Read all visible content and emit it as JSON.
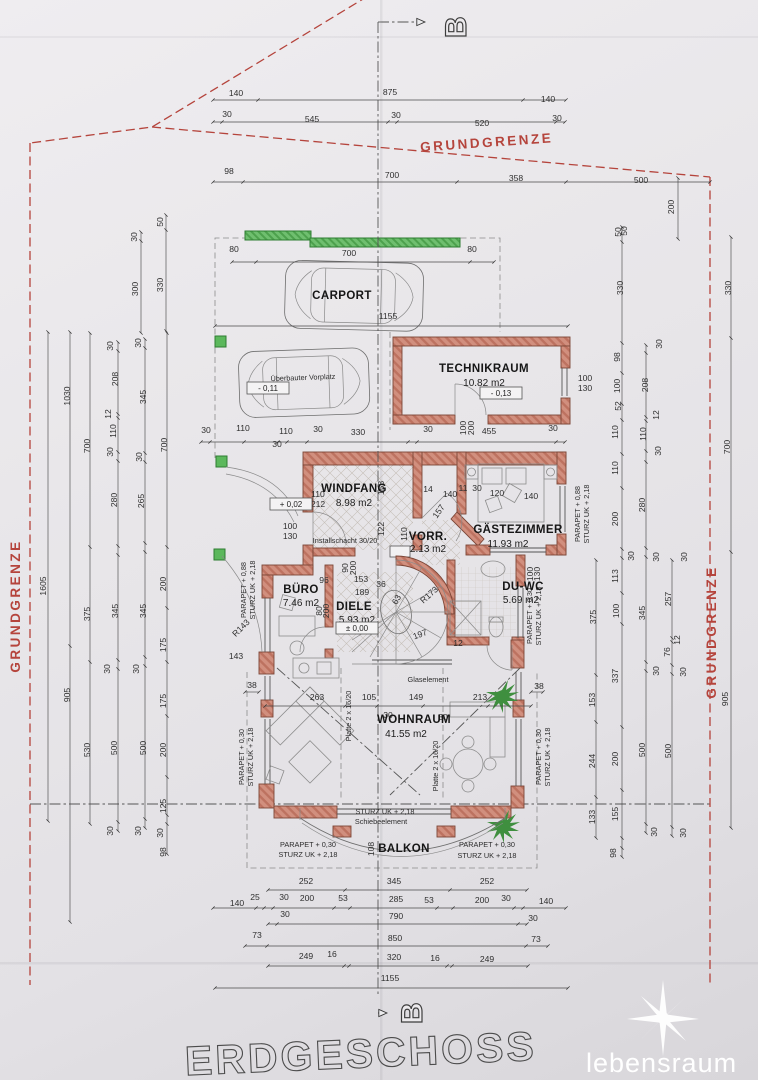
{
  "meta": {
    "title": "ERDGESCHOSS",
    "logo": "lebensraum",
    "section_marker": "B"
  },
  "boundary": {
    "label": "GRUNDGRENZE",
    "color": "#b5443c",
    "instances": [
      {
        "x": 487,
        "y": 147,
        "r": -4
      },
      {
        "x": 20,
        "y": 606,
        "r": -90
      },
      {
        "x": 716,
        "y": 632,
        "r": -90
      }
    ]
  },
  "colors": {
    "wall": "#cf8f7e",
    "wall_edge": "#7c4637",
    "green": "#5cb85c",
    "boundary": "#b5443c",
    "paper": "#e8e6e9",
    "line": "#4a4a4a"
  },
  "rooms": [
    {
      "name": "CARPORT",
      "x": 342,
      "y": 299
    },
    {
      "name": "TECHNIKRAUM",
      "area": "10.82 m2",
      "x": 484,
      "y": 372,
      "ax": 484,
      "ay": 386
    },
    {
      "name": "WINDFANG",
      "area": "8.98 m2",
      "x": 354,
      "y": 492,
      "ax": 354,
      "ay": 506
    },
    {
      "name": "VORR.",
      "area": "2.13 m2",
      "x": 428,
      "y": 540,
      "ax": 428,
      "ay": 552
    },
    {
      "name": "GÄSTEZIMMER",
      "area": "11.93 m2",
      "x": 518,
      "y": 533,
      "ax": 508,
      "ay": 547
    },
    {
      "name": "BÜRO",
      "area": "7.46 m2",
      "x": 301,
      "y": 593,
      "ax": 301,
      "ay": 606
    },
    {
      "name": "DIELE",
      "area": "5.93 m2",
      "x": 354,
      "y": 610,
      "ax": 357,
      "ay": 623
    },
    {
      "name": "DU-WC",
      "area": "5.69 m2",
      "x": 523,
      "y": 590,
      "ax": 521,
      "ay": 603
    },
    {
      "name": "WOHNRAUM",
      "area": "41.55 m2",
      "x": 414,
      "y": 723,
      "ax": 406,
      "ay": 737
    },
    {
      "name": "BALKON",
      "x": 404,
      "y": 852
    }
  ],
  "level_boxes": [
    {
      "t": "- 0,11",
      "x": 268,
      "y": 391
    },
    {
      "t": "- 0,13",
      "x": 501,
      "y": 396
    },
    {
      "t": "+ 0,02",
      "x": 291,
      "y": 507
    },
    {
      "t": "± 0,00",
      "x": 357,
      "y": 631
    }
  ],
  "notes": [
    {
      "t": "Überbauter Vorplatz",
      "x": 303,
      "y": 380,
      "r": -2
    },
    {
      "t": "Installschacht 30/20",
      "x": 345,
      "y": 543
    },
    {
      "t": "Glaselement",
      "x": 428,
      "y": 682
    },
    {
      "t": "STURZ UK + 2,18",
      "x": 385,
      "y": 814
    },
    {
      "t": "Schiebeelement",
      "x": 381,
      "y": 824
    },
    {
      "t": "PARAPET + 0,30",
      "x": 308,
      "y": 847
    },
    {
      "t": "STURZ UK + 2,18",
      "x": 308,
      "y": 857
    },
    {
      "t": "PARAPET + 0,30",
      "x": 487,
      "y": 847
    },
    {
      "t": "STURZ UK + 2,18",
      "x": 487,
      "y": 858
    },
    {
      "t": "PARAPET + 0,88",
      "x": 246,
      "y": 590,
      "r": -90
    },
    {
      "t": "STURZ UK + 2,18",
      "x": 255,
      "y": 590,
      "r": -90
    },
    {
      "t": "PARAPET + 0,30",
      "x": 244,
      "y": 757,
      "r": -90
    },
    {
      "t": "STURZ UK + 2,18",
      "x": 253,
      "y": 757,
      "r": -90
    },
    {
      "t": "PARAPET + 0,88",
      "x": 580,
      "y": 514,
      "r": -90
    },
    {
      "t": "STURZ UK + 2,18",
      "x": 589,
      "y": 514,
      "r": -90
    },
    {
      "t": "PARAPET + 0,30",
      "x": 532,
      "y": 616,
      "r": -90
    },
    {
      "t": "STURZ UK + 2,18",
      "x": 541,
      "y": 616,
      "r": -90
    },
    {
      "t": "PARAPET + 0,30",
      "x": 541,
      "y": 757,
      "r": -90
    },
    {
      "t": "STURZ UK + 2,18",
      "x": 550,
      "y": 757,
      "r": -90
    },
    {
      "t": "Platte 2 x 16/20",
      "x": 351,
      "y": 716,
      "r": -90
    },
    {
      "t": "Platte 2 x 16/20",
      "x": 438,
      "y": 766,
      "r": -90
    }
  ],
  "dims": [
    [
      "140",
      236,
      96
    ],
    [
      "875",
      390,
      95
    ],
    [
      "140",
      548,
      102
    ],
    [
      "30",
      227,
      117
    ],
    [
      "545",
      312,
      122
    ],
    [
      "30",
      396,
      118
    ],
    [
      "520",
      482,
      126
    ],
    [
      "30",
      557,
      121
    ],
    [
      "98",
      229,
      174
    ],
    [
      "700",
      392,
      178
    ],
    [
      "358",
      516,
      181
    ],
    [
      "500",
      641,
      183
    ],
    [
      "200",
      674,
      207,
      -90
    ],
    [
      "50",
      627,
      231,
      -90
    ],
    [
      "80",
      234,
      252
    ],
    [
      "700",
      349,
      256
    ],
    [
      "80",
      472,
      252
    ],
    [
      "1155",
      388,
      319
    ],
    [
      "30",
      206,
      433
    ],
    [
      "110",
      243,
      431
    ],
    [
      "110",
      286,
      434
    ],
    [
      "30",
      277,
      447
    ],
    [
      "30",
      318,
      432
    ],
    [
      "330",
      358,
      435
    ],
    [
      "30",
      428,
      432
    ],
    [
      "455",
      489,
      434
    ],
    [
      "30",
      553,
      431
    ],
    [
      "100",
      466,
      428,
      -90
    ],
    [
      "200",
      474,
      428,
      -90
    ],
    [
      "100",
      585,
      381
    ],
    [
      "130",
      585,
      391
    ],
    [
      "110",
      318,
      497
    ],
    [
      "212",
      318,
      507
    ],
    [
      "100",
      290,
      529
    ],
    [
      "130",
      290,
      539
    ],
    [
      "158",
      384,
      488,
      -90
    ],
    [
      "122",
      384,
      529,
      -90
    ],
    [
      "110",
      407,
      534,
      -90
    ],
    [
      "14",
      428,
      492
    ],
    [
      "140",
      450,
      497
    ],
    [
      "11",
      463,
      491
    ],
    [
      "30",
      477,
      491
    ],
    [
      "120",
      497,
      496
    ],
    [
      "140",
      531,
      499
    ],
    [
      "157",
      441,
      513,
      -55
    ],
    [
      "90",
      348,
      568,
      -90
    ],
    [
      "200",
      356,
      568,
      -90
    ],
    [
      "96",
      324,
      583
    ],
    [
      "153",
      361,
      582
    ],
    [
      "36",
      381,
      587
    ],
    [
      "189",
      362,
      595
    ],
    [
      "80",
      322,
      611,
      -90
    ],
    [
      "200",
      329,
      611,
      -90
    ],
    [
      "63",
      399,
      601,
      -60
    ],
    [
      "R173",
      431,
      597,
      -42
    ],
    [
      "197",
      421,
      637,
      -20
    ],
    [
      "12",
      458,
      646
    ],
    [
      "R143",
      243,
      630,
      -45
    ],
    [
      "143",
      236,
      659
    ],
    [
      "100",
      533,
      574,
      -90
    ],
    [
      "130",
      540,
      574,
      -90
    ],
    [
      "38",
      252,
      688
    ],
    [
      "263",
      317,
      700
    ],
    [
      "105",
      369,
      700
    ],
    [
      "149",
      416,
      700
    ],
    [
      "213",
      480,
      700
    ],
    [
      "38",
      539,
      689
    ],
    [
      "30",
      388,
      718
    ],
    [
      "30",
      443,
      720
    ],
    [
      "108",
      374,
      849,
      -90
    ],
    [
      "252",
      306,
      884
    ],
    [
      "345",
      394,
      884
    ],
    [
      "252",
      487,
      884
    ],
    [
      "140",
      237,
      906
    ],
    [
      "25",
      255,
      900
    ],
    [
      "30",
      284,
      900
    ],
    [
      "200",
      307,
      901
    ],
    [
      "53",
      343,
      901
    ],
    [
      "285",
      396,
      902
    ],
    [
      "53",
      429,
      903
    ],
    [
      "200",
      482,
      903
    ],
    [
      "30",
      506,
      901
    ],
    [
      "140",
      546,
      904
    ],
    [
      "30",
      285,
      917
    ],
    [
      "790",
      396,
      919
    ],
    [
      "30",
      533,
      921
    ],
    [
      "73",
      257,
      938
    ],
    [
      "850",
      395,
      941
    ],
    [
      "73",
      536,
      942
    ],
    [
      "249",
      306,
      959
    ],
    [
      "16",
      332,
      957
    ],
    [
      "320",
      394,
      960
    ],
    [
      "16",
      435,
      961
    ],
    [
      "249",
      487,
      962
    ],
    [
      "1155",
      390,
      981
    ],
    [
      "50",
      163,
      222,
      -90
    ],
    [
      "30",
      137,
      237,
      -90
    ],
    [
      "330",
      163,
      285,
      -90
    ],
    [
      "300",
      138,
      289,
      -90
    ],
    [
      "30",
      113,
      346,
      -90
    ],
    [
      "30",
      141,
      343,
      -90
    ],
    [
      "1030",
      70,
      396,
      -90
    ],
    [
      "700",
      90,
      446,
      -90
    ],
    [
      "700",
      167,
      445,
      -90
    ],
    [
      "208",
      118,
      379,
      -90
    ],
    [
      "345",
      146,
      397,
      -90
    ],
    [
      "12",
      111,
      414,
      -90
    ],
    [
      "110",
      116,
      431,
      -90
    ],
    [
      "30",
      113,
      452,
      -90
    ],
    [
      "30",
      142,
      457,
      -90
    ],
    [
      "280",
      117,
      500,
      -90
    ],
    [
      "265",
      144,
      501,
      -90
    ],
    [
      "1605",
      46,
      586,
      -90
    ],
    [
      "905",
      70,
      695,
      -90
    ],
    [
      "200",
      166,
      584,
      -90
    ],
    [
      "375",
      90,
      614,
      -90
    ],
    [
      "345",
      118,
      611,
      -90
    ],
    [
      "345",
      146,
      611,
      -90
    ],
    [
      "30",
      110,
      669,
      -90
    ],
    [
      "30",
      139,
      669,
      -90
    ],
    [
      "175",
      166,
      645,
      -90
    ],
    [
      "175",
      166,
      701,
      -90
    ],
    [
      "530",
      90,
      750,
      -90
    ],
    [
      "500",
      117,
      748,
      -90
    ],
    [
      "500",
      146,
      748,
      -90
    ],
    [
      "200",
      166,
      750,
      -90
    ],
    [
      "125",
      166,
      806,
      -90
    ],
    [
      "30",
      113,
      831,
      -90
    ],
    [
      "30",
      141,
      831,
      -90
    ],
    [
      "30",
      163,
      833,
      -90
    ],
    [
      "98",
      166,
      852,
      -90
    ],
    [
      "50",
      621,
      232,
      -90
    ],
    [
      "330",
      623,
      288,
      -90
    ],
    [
      "330",
      731,
      288,
      -90
    ],
    [
      "30",
      662,
      344,
      -90
    ],
    [
      "98",
      620,
      357,
      -90
    ],
    [
      "208",
      648,
      385,
      -90
    ],
    [
      "100",
      620,
      386,
      -90
    ],
    [
      "52",
      621,
      406,
      -90
    ],
    [
      "12",
      659,
      415,
      -90
    ],
    [
      "110",
      618,
      432,
      -90
    ],
    [
      "110",
      646,
      434,
      -90
    ],
    [
      "30",
      661,
      451,
      -90
    ],
    [
      "110",
      618,
      468,
      -90
    ],
    [
      "700",
      730,
      447,
      -90
    ],
    [
      "280",
      645,
      505,
      -90
    ],
    [
      "200",
      618,
      519,
      -90
    ],
    [
      "30",
      634,
      556,
      -90
    ],
    [
      "30",
      659,
      557,
      -90
    ],
    [
      "30",
      687,
      557,
      -90
    ],
    [
      "113",
      618,
      576,
      -90
    ],
    [
      "257",
      671,
      599,
      -90
    ],
    [
      "345",
      645,
      613,
      -90
    ],
    [
      "100",
      619,
      611,
      -90
    ],
    [
      "375",
      596,
      617,
      -90
    ],
    [
      "12",
      680,
      640,
      -90
    ],
    [
      "76",
      670,
      652,
      -90
    ],
    [
      "30",
      659,
      671,
      -90
    ],
    [
      "30",
      686,
      672,
      -90
    ],
    [
      "337",
      618,
      676,
      -90
    ],
    [
      "153",
      595,
      700,
      -90
    ],
    [
      "905",
      728,
      699,
      -90
    ],
    [
      "500",
      645,
      750,
      -90
    ],
    [
      "500",
      671,
      751,
      -90
    ],
    [
      "200",
      618,
      759,
      -90
    ],
    [
      "244",
      595,
      761,
      -90
    ],
    [
      "155",
      618,
      814,
      -90
    ],
    [
      "133",
      595,
      817,
      -90
    ],
    [
      "30",
      657,
      832,
      -90
    ],
    [
      "30",
      686,
      833,
      -90
    ],
    [
      "98",
      616,
      853,
      -90
    ]
  ]
}
